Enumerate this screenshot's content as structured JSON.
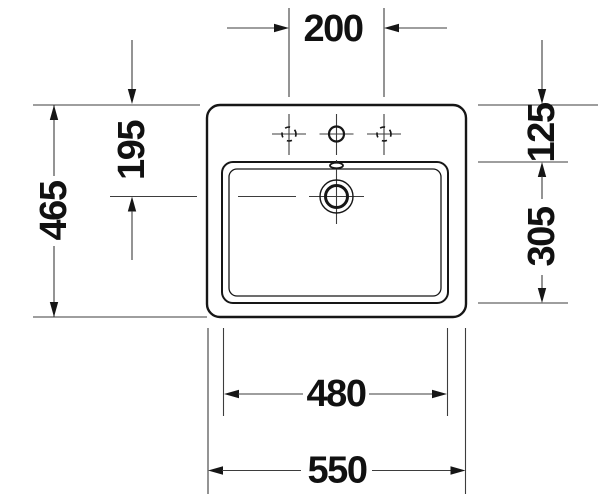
{
  "document": {
    "type": "washbasin-top-view-technical-drawing"
  },
  "dims": {
    "tap_hole_spacing": "200",
    "front_to_drain_center": "195",
    "overall_depth": "465",
    "rim_to_basin_front": "125",
    "basin_depth": "305",
    "basin_width": "480",
    "overall_width": "550"
  },
  "colors": {
    "outline": "#161616",
    "dimension_lines": "#3d3d3d",
    "text": "#111111",
    "background": "#ffffff"
  }
}
